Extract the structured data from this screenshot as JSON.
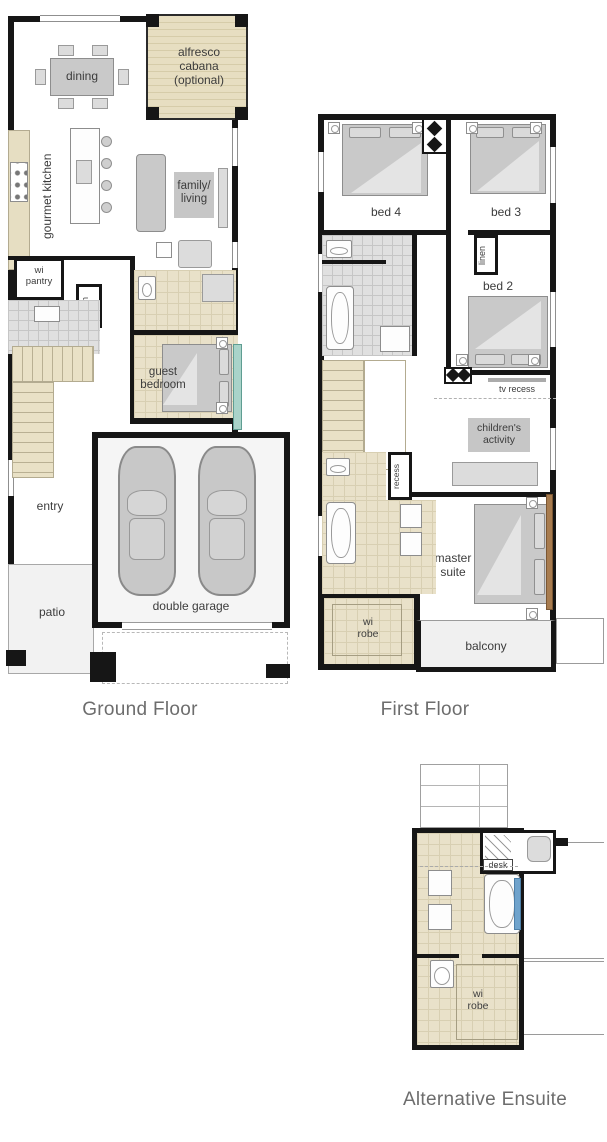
{
  "colors": {
    "wall": "#161616",
    "tile_beige": "#e9e1c9",
    "tile_gray": "#e0e0e0",
    "decking_beige": "#e7dec1",
    "furniture_gray": "#c9c9c9",
    "label_text": "#3c3c3c",
    "caption_text": "#6d6d6d",
    "window_aqua": "#a9d3c9",
    "window_blue": "#6fa3cc",
    "timber_screen": "#a87c4f"
  },
  "plans": {
    "ground": {
      "caption": "Ground Floor",
      "rooms": {
        "dining": "dining",
        "alfresco": "alfresco\ncabana\n(optional)",
        "kitchen": "gourmet kitchen",
        "family_living": "family/\nliving",
        "wi_pantry": "wi\npantry",
        "linen": "linen",
        "guest_bedroom": "guest\nbedroom",
        "entry": "entry",
        "patio": "patio",
        "double_garage": "double garage"
      }
    },
    "first": {
      "caption": "First Floor",
      "rooms": {
        "bed4": "bed 4",
        "bed3": "bed 3",
        "linen": "linen",
        "bed2": "bed 2",
        "tv_recess": "tv recess",
        "childrens_activity": "children's\nactivity",
        "recess": "recess",
        "master_suite": "master\nsuite",
        "wi_robe": "wi\nrobe",
        "balcony": "balcony"
      }
    },
    "alt_ensuite": {
      "caption": "Alternative Ensuite",
      "rooms": {
        "desk": "desk",
        "wi_robe": "wi\nrobe"
      }
    }
  }
}
